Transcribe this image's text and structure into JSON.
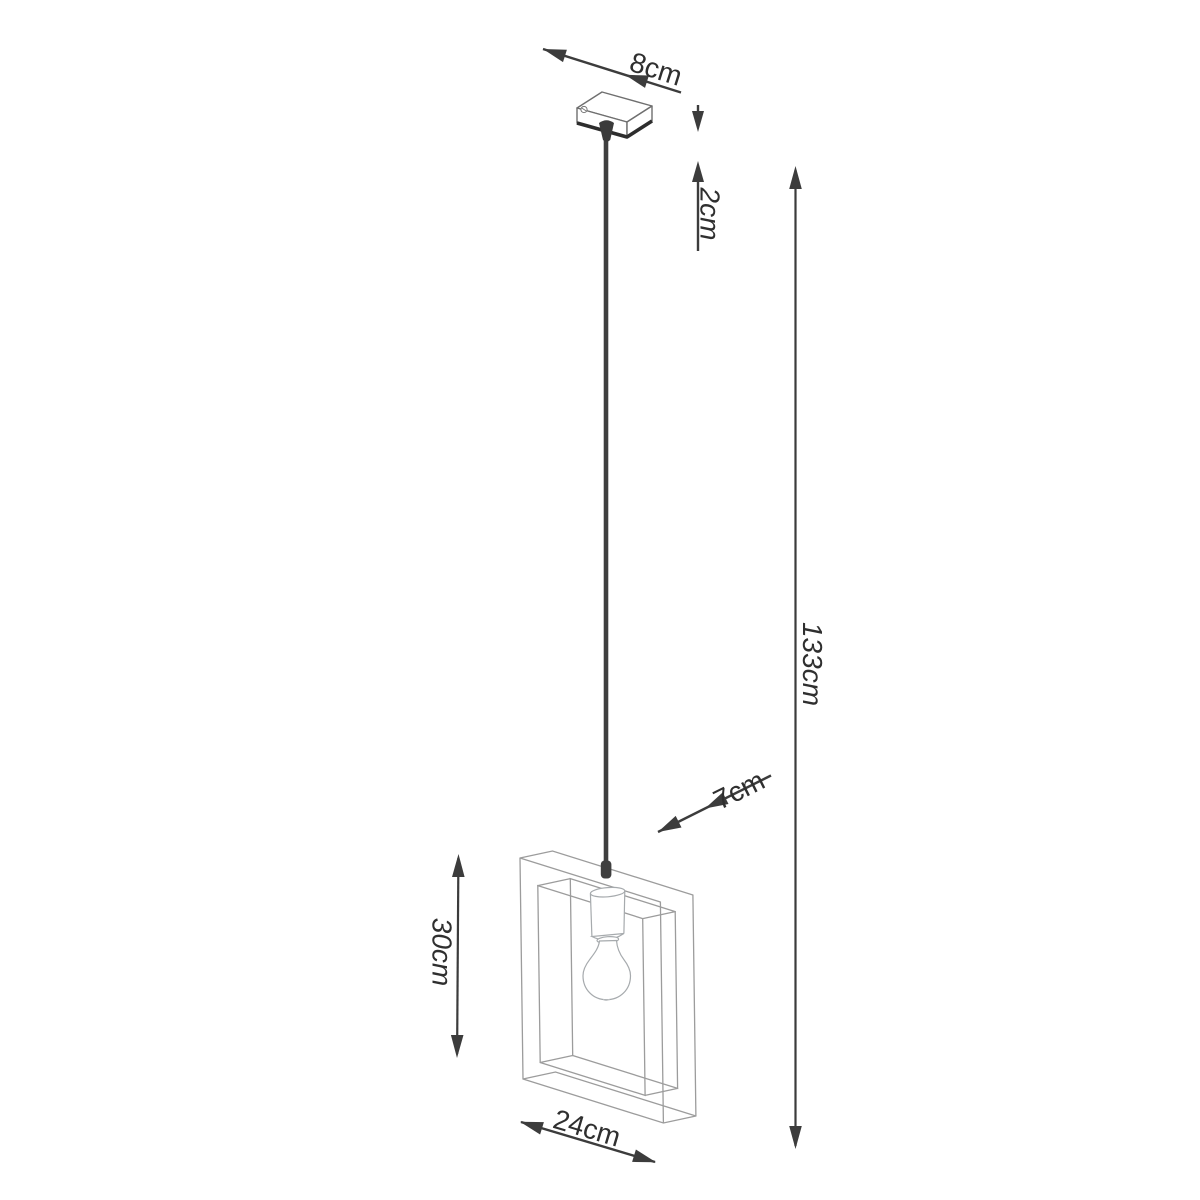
{
  "diagram": {
    "kind": "product dimension drawing",
    "subject": "square frame single pendant lamp with exposed bulb",
    "background": "#ffffff"
  },
  "labels": {
    "canopy_width": "8cm",
    "canopy_height": "2cm",
    "total_drop": "133cm",
    "shade_depth": "7cm",
    "shade_height": "30cm",
    "shade_width": "24cm"
  },
  "values_cm": {
    "canopy_width": 8,
    "canopy_height": 2,
    "total_drop": 133,
    "shade_depth": 7,
    "shade_height": 30,
    "shade_width": 24
  },
  "colors": {
    "dimension_ink": "#3c3c3c",
    "label_text": "#2f2f2f",
    "frame_wireframe": "#9c9c9c",
    "canopy_outline": "#6f6f6f",
    "canopy_dark_edge": "#2d2d2d",
    "cord": "#3f3f3f",
    "lamp_outline": "#a6aaad",
    "background": "#ffffff"
  }
}
